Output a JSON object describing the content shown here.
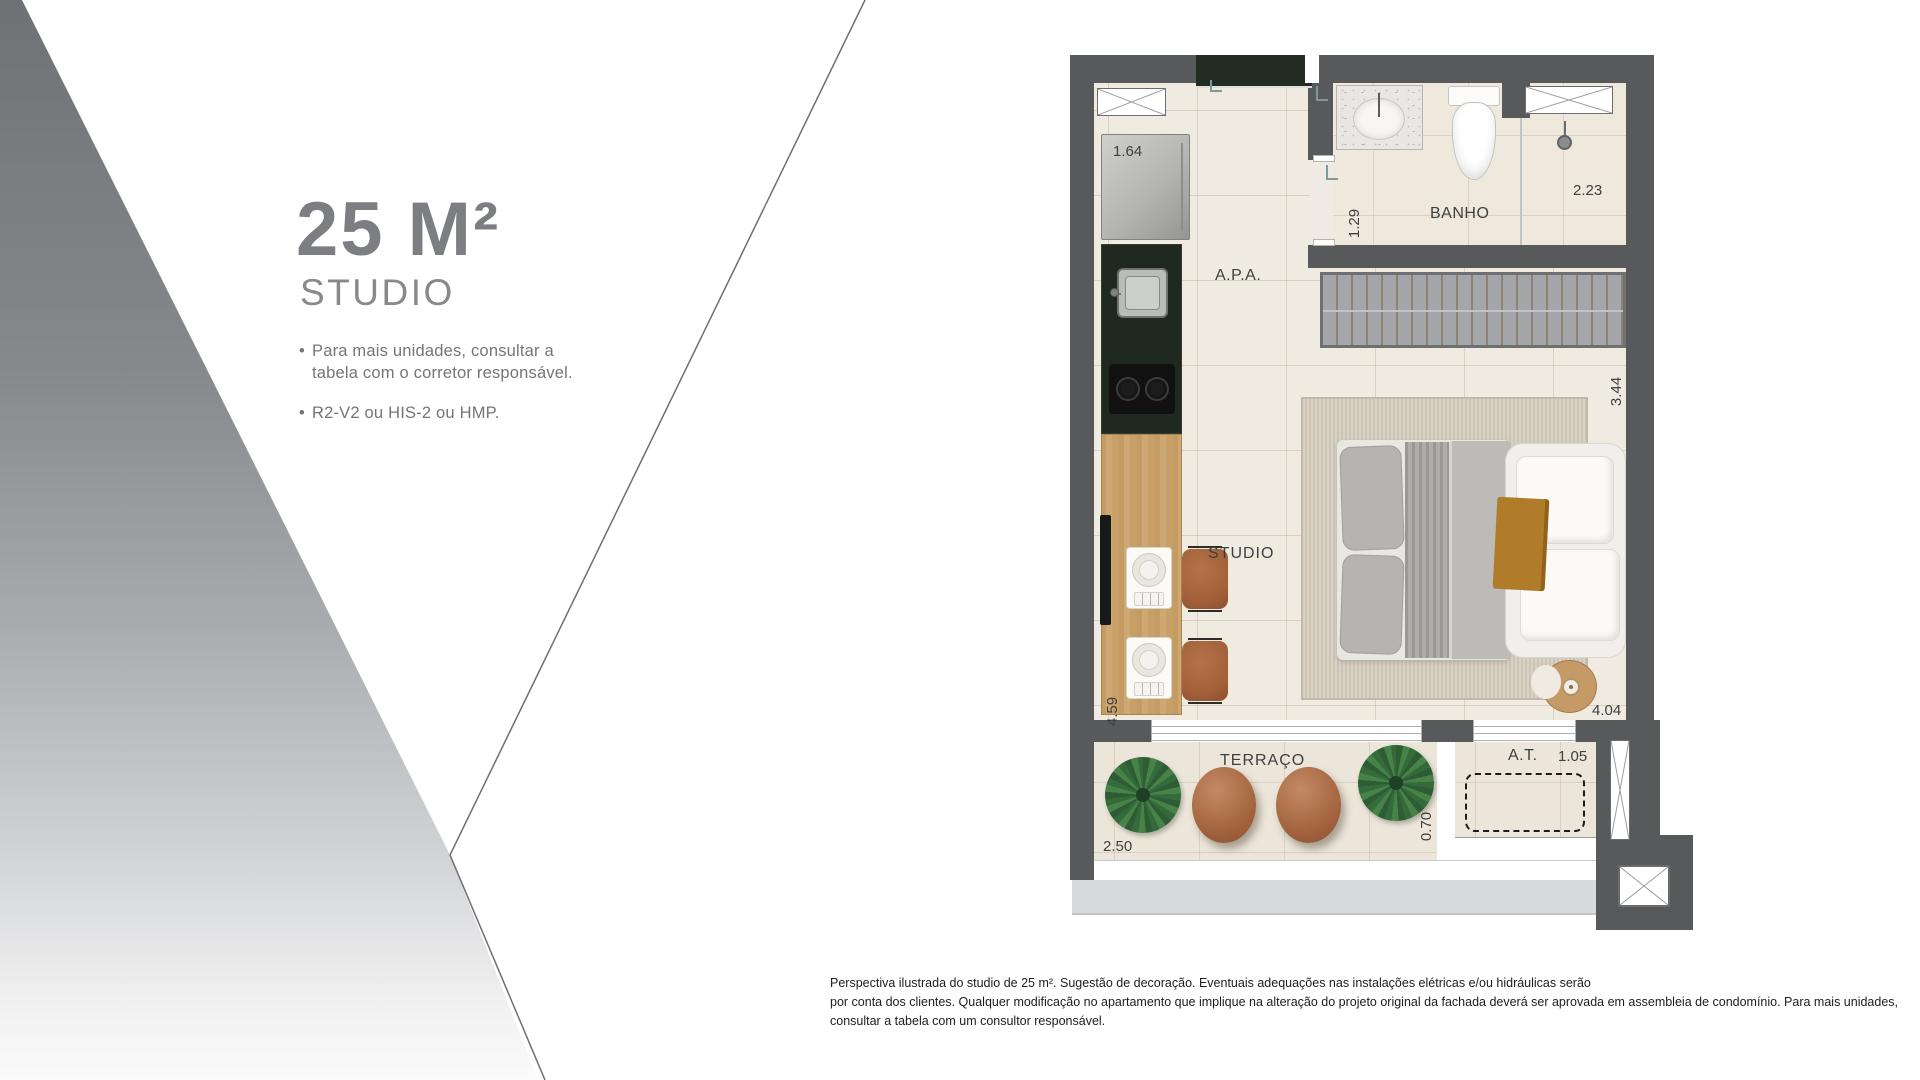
{
  "panel": {
    "title": "25 M²",
    "subtitle": "STUDIO",
    "bullet_char": "•",
    "bullets": [
      "Para mais unidades, consultar a tabela com o corretor responsável.",
      "R2-V2 ou HIS-2 ou HMP."
    ]
  },
  "plan": {
    "labels": {
      "apa": "A.P.A.",
      "banho": "BANHO",
      "studio": "STUDIO",
      "terraco": "TERRAÇO",
      "at": "A.T."
    },
    "dimensions": {
      "kitchen_run": "1.64",
      "bath_entry": "1.29",
      "bath_width": "2.23",
      "bedroom_width": "3.44",
      "studio_length": "4.59",
      "studio_width": "4.04",
      "terrace_width": "2.50",
      "terrace_depth": "0.70",
      "at_width": "1.05"
    }
  },
  "footer": {
    "lines": [
      "Perspectiva ilustrada do studio de 25 m². Sugestão de decoração. Eventuais adequações nas instalações elétricas e/ou hidráulicas serão",
      "por conta dos clientes. Qualquer modificação no apartamento que implique na alteração do projeto original da fachada deverá ser aprovada em assembleia de condomínio. Para mais unidades,",
      "consultar a tabela com um consultor responsável."
    ]
  },
  "colors": {
    "wall": "#58595b",
    "floor": "#f0ebe1",
    "accent_wood": "#c8a26e",
    "counter_green": "#1f2920",
    "pouf_brown": "#a4653f",
    "mustard": "#b07c2a",
    "title_gray": "#7c7e81"
  }
}
